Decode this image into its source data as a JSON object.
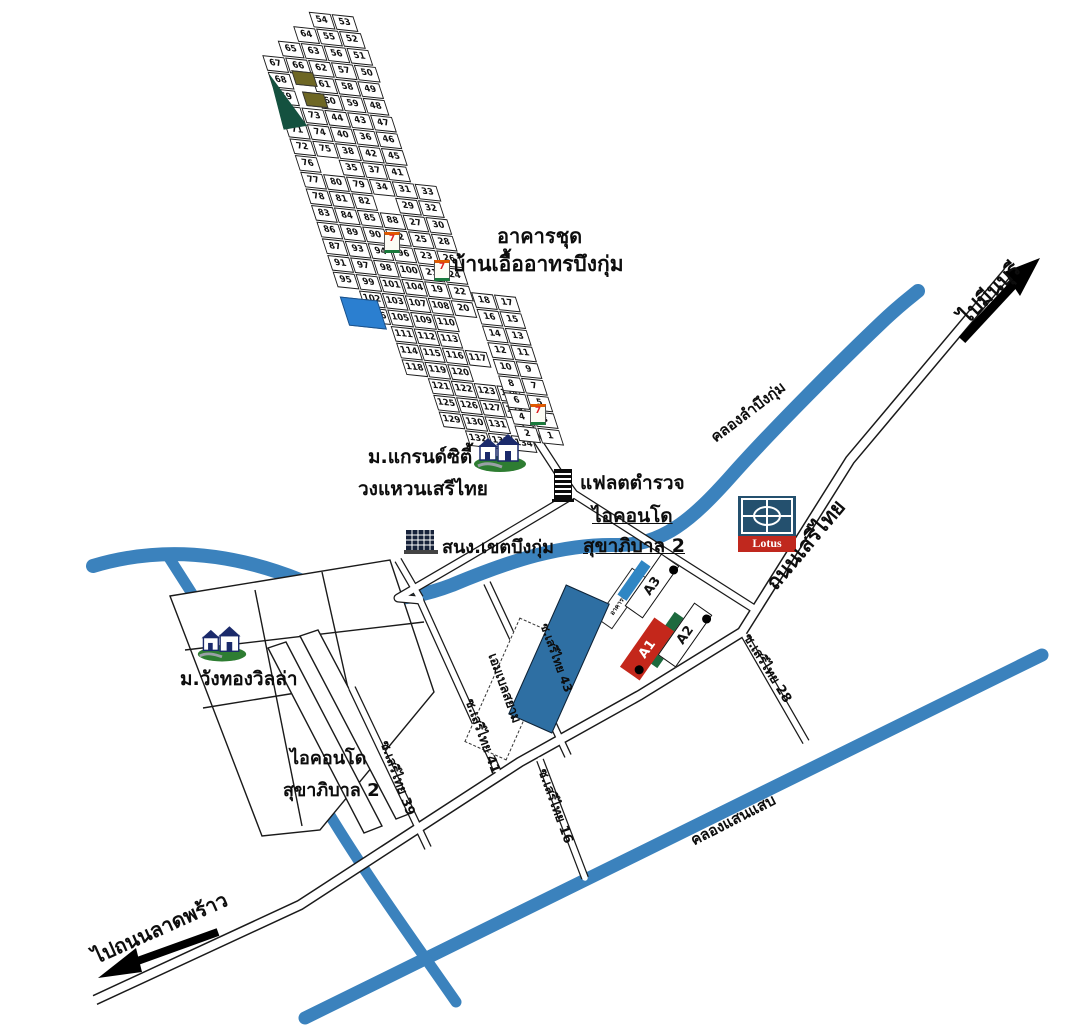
{
  "labels": {
    "condo_line1": "อาคารชุด",
    "condo_line2": "บ้านเอื้ออาทรบึงกุ่ม",
    "grandcity_line1": "ม.แกรนด์ซิตี้",
    "grandcity_line2": "วงแหวนเสรีไทย",
    "police_flats": "แฟลตตำรวจ",
    "icondo_right_line1": "ไอคอนโด",
    "icondo_right_line2": "สุขาภิบาล 2",
    "district_office": "สนง.เขตบึงกุ่ม",
    "wangthong": "ม.วังทองวิลล่า",
    "icondo_left_line1": "ไอคอนโด",
    "icondo_left_line2": "สุขาภิบาล 2",
    "serithai_road": "ถนนเสรีไทย",
    "to_minburi": "ไปมีนบุรี",
    "to_latphrao": "ไปถนนลาดพร้าว",
    "canal_buengkum": "คลองลำบึงกุ่ม",
    "canal_saensaep": "คลองแสนแสบ",
    "soi16": "ซ.เสรีไทย 16",
    "soi28": "ซ.เสรีไทย 28",
    "soi39": "ซ.เสรีไทย 39",
    "soi41": "ซ.เสรีไทย 41",
    "soi43": "ซ.เสรีไทย 43",
    "emerald_block": "เอมเบลสยาม",
    "parking": "อาคารจอดรถ",
    "block_a1": "A1",
    "block_a2": "A2",
    "block_a3": "A3",
    "lotus": "Lotus",
    "seven": "7"
  },
  "colors": {
    "canal": "#3b82bd",
    "road_casing": "#1a1a1a",
    "block_red": "#c4271b",
    "block_green": "#1d6a3e",
    "lotus_navy": "#24506e",
    "lotus_red": "#c0281e",
    "pool_blue": "#2b7fd0",
    "olive": "#6e6724",
    "triangle_green": "#14513f",
    "strip_blue": "#2f86c4",
    "big_blue": "#2e6fa3"
  },
  "estate": {
    "main_rows": [
      {
        "pad": 3,
        "cells": [
          54,
          53
        ]
      },
      {
        "pad": 2,
        "cells": [
          64,
          55,
          52
        ]
      },
      {
        "pad": 1,
        "cells": [
          65,
          63,
          56,
          51
        ]
      },
      {
        "pad": 0,
        "cells": [
          67,
          66,
          62,
          57,
          50
        ]
      },
      {
        "pad": 0,
        "cells": [
          68,
          null,
          61,
          58,
          49
        ]
      },
      {
        "pad": 0,
        "cells": [
          69,
          null,
          60,
          59,
          48
        ]
      },
      {
        "pad": 0,
        "cells": [
          70,
          73,
          44,
          43,
          47
        ]
      },
      {
        "pad": 0,
        "cells": [
          71,
          74,
          40,
          36,
          46
        ]
      },
      {
        "pad": 0,
        "cells": [
          72,
          75,
          38,
          42,
          45
        ]
      },
      {
        "pad": 0,
        "cells": [
          76,
          null,
          35,
          37,
          41
        ]
      },
      {
        "pad": 0,
        "cells": [
          77,
          80,
          79,
          34,
          31,
          33
        ]
      },
      {
        "pad": 0,
        "cells": [
          78,
          81,
          82,
          null,
          29,
          32
        ]
      },
      {
        "pad": 0,
        "cells": [
          83,
          84,
          85,
          88,
          27,
          30
        ]
      },
      {
        "pad": 0,
        "cells": [
          86,
          89,
          90,
          92,
          25,
          28
        ]
      },
      {
        "pad": 0,
        "cells": [
          87,
          93,
          94,
          96,
          23,
          26
        ]
      },
      {
        "pad": 0,
        "cells": [
          91,
          97,
          98,
          100,
          21,
          24
        ]
      },
      {
        "pad": 0,
        "cells": [
          95,
          99,
          101,
          104,
          19,
          22
        ]
      },
      {
        "pad": 1,
        "cells": [
          102,
          103,
          107,
          108,
          20
        ]
      },
      {
        "pad": 1,
        "cells": [
          106,
          105,
          109,
          110
        ]
      },
      {
        "pad": 2,
        "cells": [
          111,
          112,
          113
        ]
      },
      {
        "pad": 2,
        "cells": [
          114,
          115,
          116,
          117
        ]
      },
      {
        "pad": 2,
        "cells": [
          118,
          119,
          120
        ]
      },
      {
        "pad": 3,
        "cells": [
          121,
          122,
          123,
          124
        ]
      },
      {
        "pad": 3,
        "cells": [
          125,
          126,
          127,
          128
        ]
      },
      {
        "pad": 3,
        "cells": [
          129,
          130,
          131
        ]
      },
      {
        "pad": 4,
        "cells": [
          132,
          133,
          134
        ]
      }
    ],
    "east_rows": [
      {
        "pad": 0,
        "cells": [
          18,
          17
        ]
      },
      {
        "pad": 0,
        "cells": [
          16,
          15
        ]
      },
      {
        "pad": 0,
        "cells": [
          14,
          13
        ]
      },
      {
        "pad": 0,
        "cells": [
          12,
          11
        ]
      },
      {
        "pad": 0,
        "cells": [
          10,
          9
        ]
      },
      {
        "pad": 0,
        "cells": [
          8,
          7
        ]
      },
      {
        "pad": 0,
        "cells": [
          6,
          5
        ]
      },
      {
        "pad": 0,
        "cells": [
          4,
          3
        ]
      },
      {
        "pad": 0,
        "cells": [
          2,
          1
        ]
      }
    ]
  }
}
